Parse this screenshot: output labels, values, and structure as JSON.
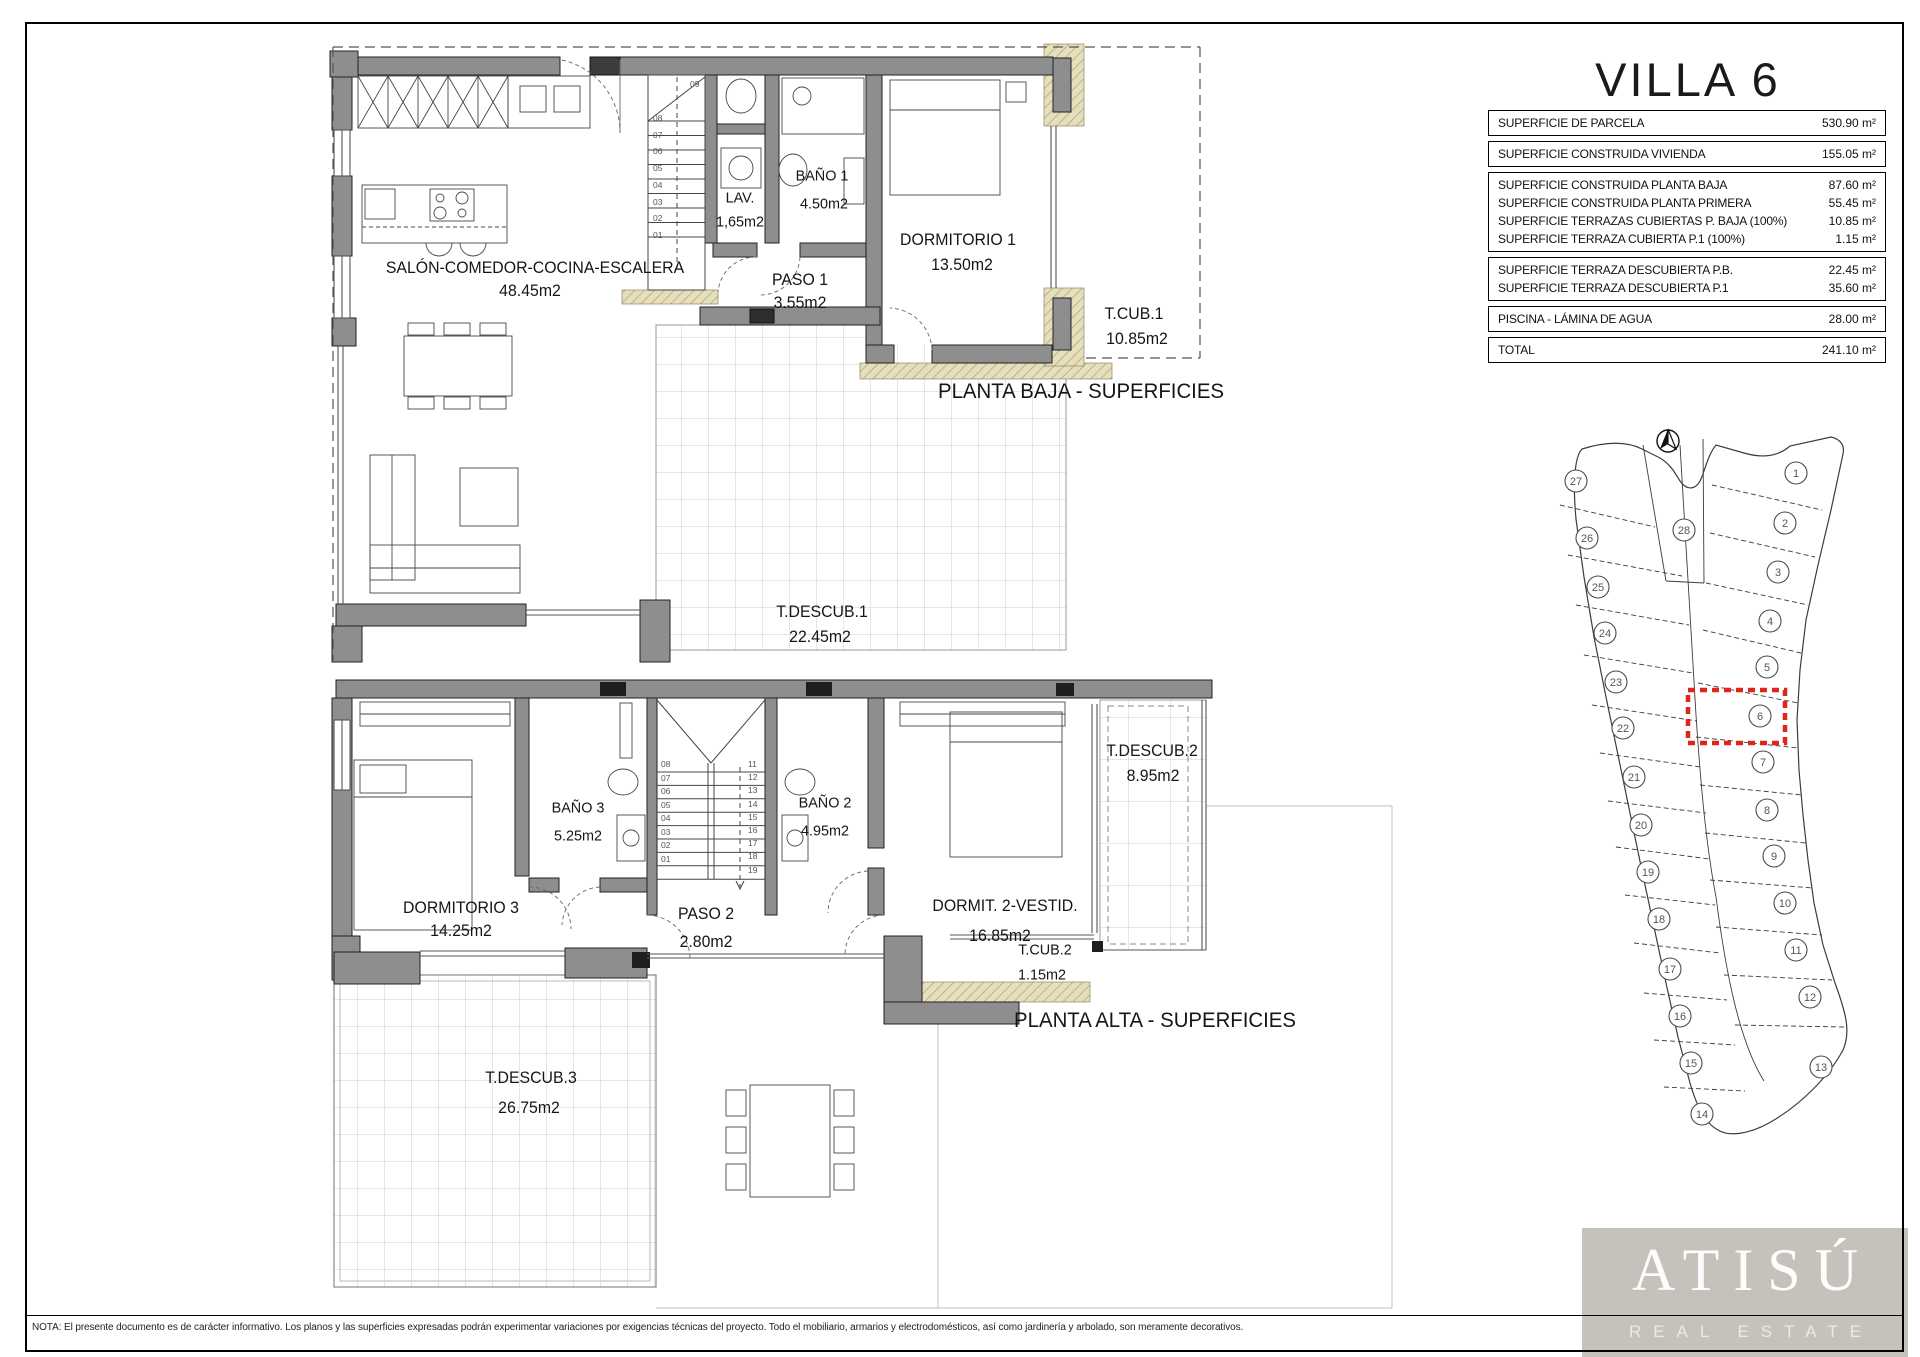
{
  "sheet": {
    "title": "VILLA 6",
    "footer_note": "NOTA: El presente documento es de carácter informativo. Los planos y las superficies expresadas podrán experimentar variaciones por exigencias técnicas del proyecto. Todo el mobiliario, armarios y electrodomésticos, así como jardinería y arbolado, son meramente decorativos."
  },
  "logo": {
    "name": "ATISÚ",
    "tagline": "REAL ESTATE"
  },
  "surface_table": {
    "groups": [
      {
        "rows": [
          {
            "label": "SUPERFICIE DE PARCELA",
            "value": "530.90 m²"
          }
        ]
      },
      {
        "rows": [
          {
            "label": "SUPERFICIE CONSTRUIDA VIVIENDA",
            "value": "155.05 m²"
          }
        ]
      },
      {
        "rows": [
          {
            "label": "SUPERFICIE CONSTRUIDA PLANTA BAJA",
            "value": "87.60 m²"
          },
          {
            "label": "SUPERFICIE CONSTRUIDA PLANTA PRIMERA",
            "value": "55.45 m²"
          },
          {
            "label": "SUPERFICIE TERRAZAS CUBIERTAS P. BAJA (100%)",
            "value": "10.85 m²"
          },
          {
            "label": "SUPERFICIE TERRAZA CUBIERTA P.1 (100%)",
            "value": "1.15 m²"
          }
        ]
      },
      {
        "rows": [
          {
            "label": "SUPERFICIE TERRAZA DESCUBIERTA P.B.",
            "value": "22.45 m²"
          },
          {
            "label": "SUPERFICIE TERRAZA DESCUBIERTA P.1",
            "value": "35.60 m²"
          }
        ]
      },
      {
        "rows": [
          {
            "label": "PISCINA - LÁMINA DE AGUA",
            "value": "28.00 m²"
          }
        ]
      },
      {
        "rows": [
          {
            "label": "TOTAL",
            "value": "241.10 m²"
          }
        ]
      }
    ]
  },
  "ground_floor": {
    "caption": "PLANTA BAJA - SUPERFICIES",
    "rooms": {
      "salon": {
        "name": "SALÓN-COMEDOR-COCINA-ESCALERA",
        "area": "48.45m2"
      },
      "lav": {
        "name": "LAV.",
        "area": "1,65m2"
      },
      "bano1": {
        "name": "BAÑO 1",
        "area": "4.50m2"
      },
      "paso1": {
        "name": "PASO 1",
        "area": "3.55m2"
      },
      "dorm1": {
        "name": "DORMITORIO 1",
        "area": "13.50m2"
      },
      "tcub1": {
        "name": "T.CUB.1",
        "area": "10.85m2"
      },
      "tdescub1": {
        "name": "T.DESCUB.1",
        "area": "22.45m2"
      }
    },
    "stairs": {
      "top_label": "09",
      "column": [
        "08",
        "07",
        "06",
        "05",
        "04",
        "03",
        "02",
        "01"
      ]
    }
  },
  "upper_floor": {
    "caption": "PLANTA ALTA - SUPERFICIES",
    "rooms": {
      "dorm3": {
        "name": "DORMITORIO 3",
        "area": "14.25m2"
      },
      "bano3": {
        "name": "BAÑO 3",
        "area": "5.25m2"
      },
      "paso2": {
        "name": "PASO 2",
        "area": "2.80m2"
      },
      "bano2": {
        "name": "BAÑO 2",
        "area": "4.95m2"
      },
      "dorm2": {
        "name": "DORMIT. 2-VESTID.",
        "area": "16.85m2"
      },
      "tcub2": {
        "name": "T.CUB.2",
        "area": "1.15m2"
      },
      "tdescub2": {
        "name": "T.DESCUB.2",
        "area": "8.95m2"
      },
      "tdescub3": {
        "name": "T.DESCUB.3",
        "area": "26.75m2"
      }
    },
    "stairs": {
      "left_column": [
        "08",
        "07",
        "06",
        "05",
        "04",
        "03",
        "02",
        "01"
      ],
      "right_column": [
        "11",
        "12",
        "13",
        "14",
        "15",
        "16",
        "17",
        "18",
        "19"
      ]
    }
  },
  "site_plan": {
    "highlighted_plot": "6",
    "highlight_color": "#e0251b",
    "plots": [
      {
        "n": "27",
        "x": 46,
        "y": 66
      },
      {
        "n": "26",
        "x": 57,
        "y": 123
      },
      {
        "n": "25",
        "x": 68,
        "y": 172
      },
      {
        "n": "24",
        "x": 75,
        "y": 218
      },
      {
        "n": "23",
        "x": 86,
        "y": 267
      },
      {
        "n": "22",
        "x": 93,
        "y": 313
      },
      {
        "n": "21",
        "x": 104,
        "y": 362
      },
      {
        "n": "20",
        "x": 111,
        "y": 410
      },
      {
        "n": "19",
        "x": 118,
        "y": 457
      },
      {
        "n": "18",
        "x": 129,
        "y": 504
      },
      {
        "n": "17",
        "x": 140,
        "y": 554
      },
      {
        "n": "16",
        "x": 150,
        "y": 601
      },
      {
        "n": "15",
        "x": 161,
        "y": 648
      },
      {
        "n": "14",
        "x": 172,
        "y": 699
      },
      {
        "n": "28",
        "x": 154,
        "y": 115
      },
      {
        "n": "1",
        "x": 266,
        "y": 58
      },
      {
        "n": "2",
        "x": 255,
        "y": 108
      },
      {
        "n": "3",
        "x": 248,
        "y": 157
      },
      {
        "n": "4",
        "x": 240,
        "y": 206
      },
      {
        "n": "5",
        "x": 237,
        "y": 252
      },
      {
        "n": "6",
        "x": 230,
        "y": 301
      },
      {
        "n": "7",
        "x": 233,
        "y": 347
      },
      {
        "n": "8",
        "x": 237,
        "y": 395
      },
      {
        "n": "9",
        "x": 244,
        "y": 441
      },
      {
        "n": "10",
        "x": 255,
        "y": 488
      },
      {
        "n": "11",
        "x": 266,
        "y": 535
      },
      {
        "n": "12",
        "x": 280,
        "y": 582
      },
      {
        "n": "13",
        "x": 291,
        "y": 652
      }
    ]
  }
}
